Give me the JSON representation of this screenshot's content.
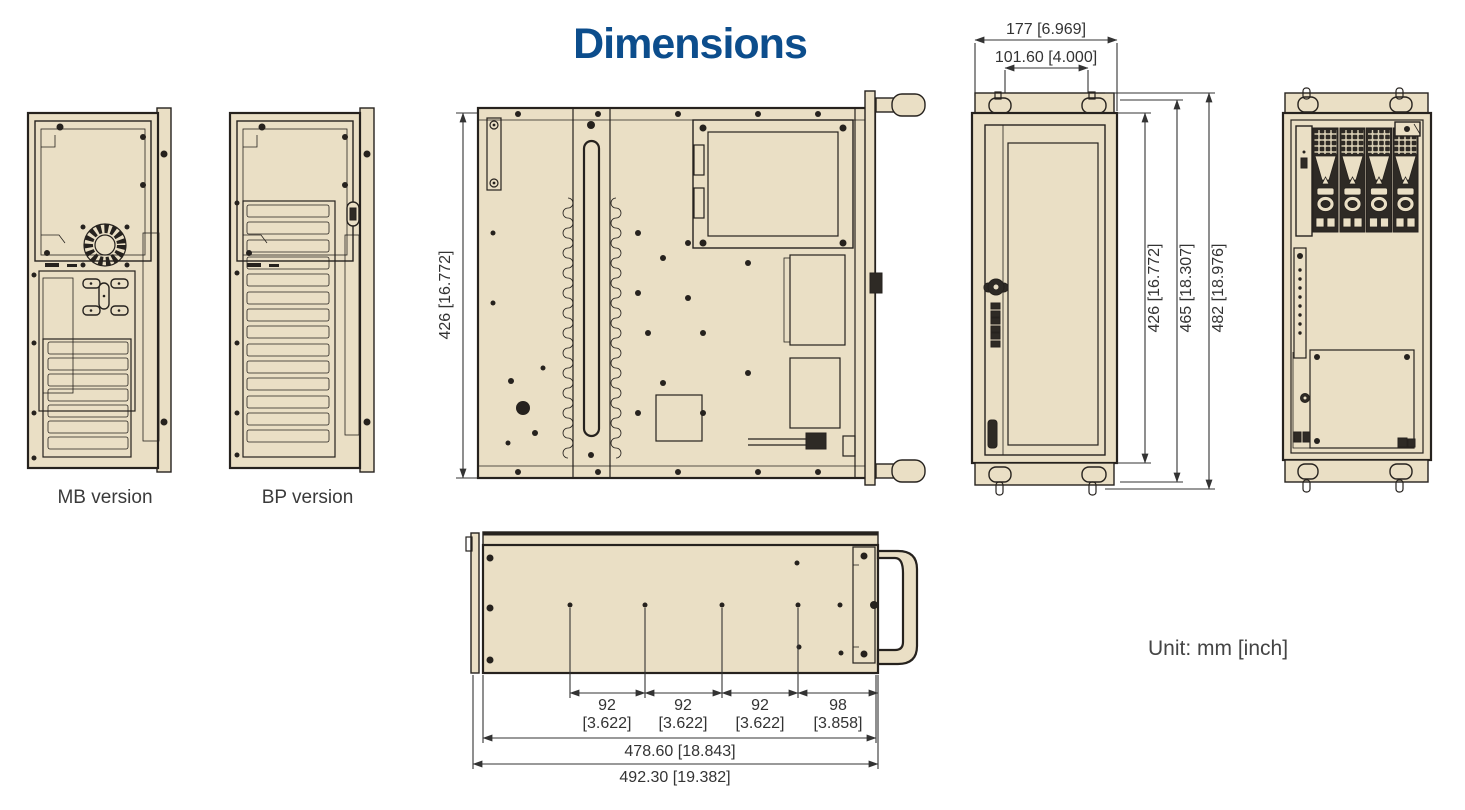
{
  "title": "Dimensions",
  "unit_label": "Unit: mm [inch]",
  "views": {
    "rear_mb": {
      "label": "MB version"
    },
    "rear_bp": {
      "label": "BP version"
    }
  },
  "dims": {
    "top_depth": "426 [16.772]",
    "front_width": "177 [6.969]",
    "handle_width": "101.60 [4.000]",
    "front_inner_height": "426 [16.772]",
    "front_mid_height": "465 [18.307]",
    "front_total_height": "482 [18.976]",
    "side_spans": [
      {
        "mm": "92",
        "inch": "[3.622]"
      },
      {
        "mm": "92",
        "inch": "[3.622]"
      },
      {
        "mm": "92",
        "inch": "[3.622]"
      },
      {
        "mm": "98",
        "inch": "[3.858]"
      }
    ],
    "side_length_inner": "478.60 [18.843]",
    "side_length_total": "492.30 [19.382]"
  },
  "colors": {
    "fill": "#eadfc5",
    "line": "#26221e",
    "dark": "#2e2a25",
    "title": "#0c4d8c",
    "dim": "#333333"
  }
}
